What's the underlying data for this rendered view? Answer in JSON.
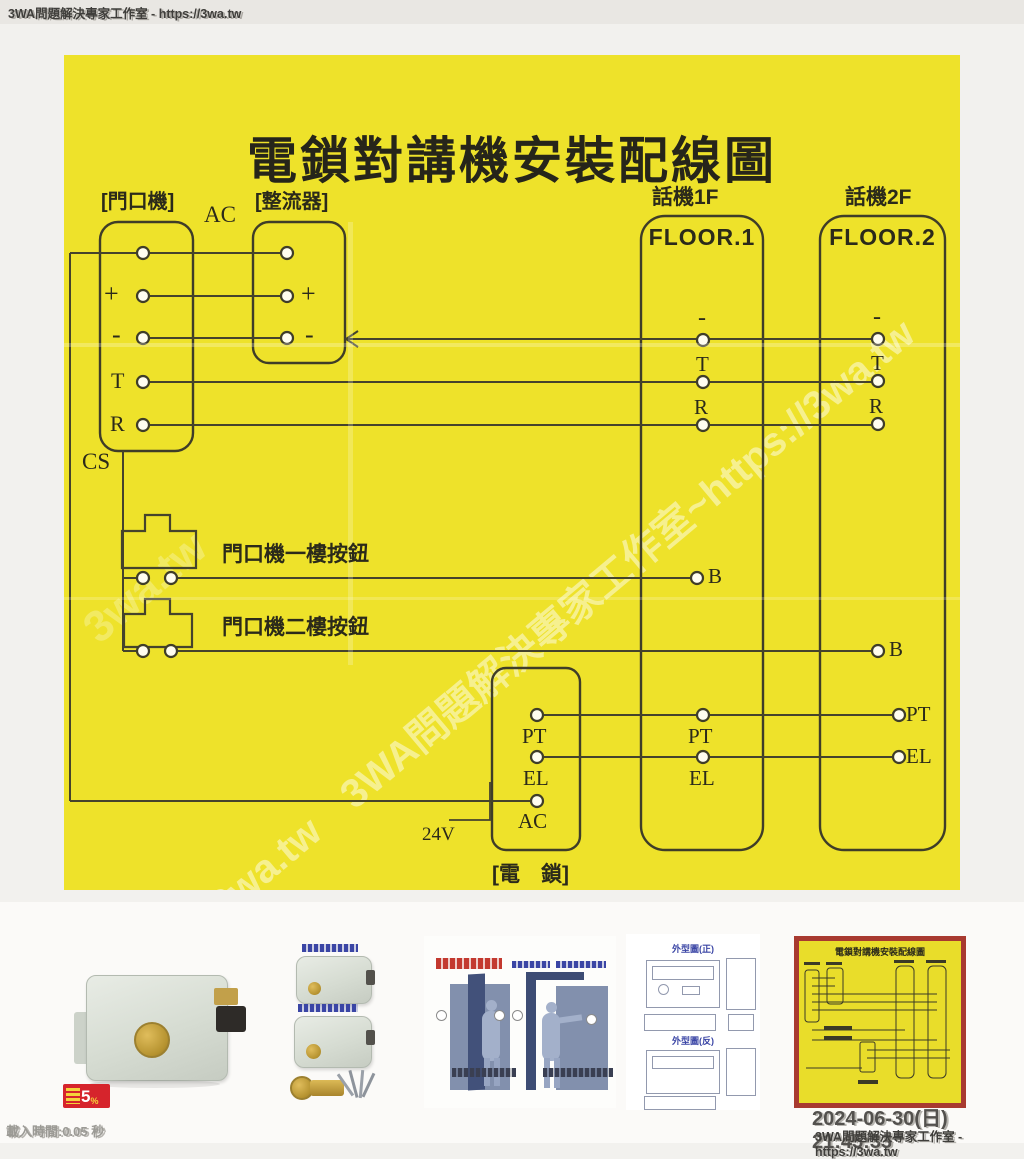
{
  "header": {
    "site": "3WA問題解決專家工作室 - https://3wa.tw"
  },
  "diagram": {
    "title": "電鎖對講機安裝配線圖",
    "ac_label": "AC",
    "cs_label": "CS",
    "volt_label": "24V",
    "door": {
      "label": "[門口機]",
      "plus": "+",
      "minus": "-",
      "t": "T",
      "r": "R"
    },
    "rectifier": {
      "label": "[整流器]",
      "plus": "+",
      "minus": "-"
    },
    "floor1": {
      "header": "話機1F",
      "name": "FLOOR.1",
      "minus": "-",
      "t": "T",
      "r": "R",
      "b": "B",
      "pt": "PT",
      "el": "EL"
    },
    "floor2": {
      "header": "話機2F",
      "name": "FLOOR.2",
      "minus": "-",
      "t": "T",
      "r": "R",
      "b": "B",
      "pt": "PT",
      "el": "EL"
    },
    "lock": {
      "label": "[電　鎖]",
      "pt": "PT",
      "el": "EL",
      "ac": "AC"
    },
    "button1_label": "門口機一樓按鈕",
    "button2_label": "門口機二樓按鈕",
    "watermark_diagonal": "3wa.tw　3WA問題解決專家工作室~https://3wa.tw",
    "watermark_small": "3wa.tw"
  },
  "thumbnails": {
    "badge_number": "5",
    "badge_percent": "%",
    "t4_front_label": "外型圖(正)",
    "t4_back_label": "外型圖(反)",
    "t5_title": "電鎖對講機安裝配線圖"
  },
  "footer": {
    "datetime": "2024-06-30(日) 21:45:33",
    "site": "3WA問題解決專家工作室 - https://3wa.tw",
    "load_time": "載入時間:0.05 秒"
  }
}
